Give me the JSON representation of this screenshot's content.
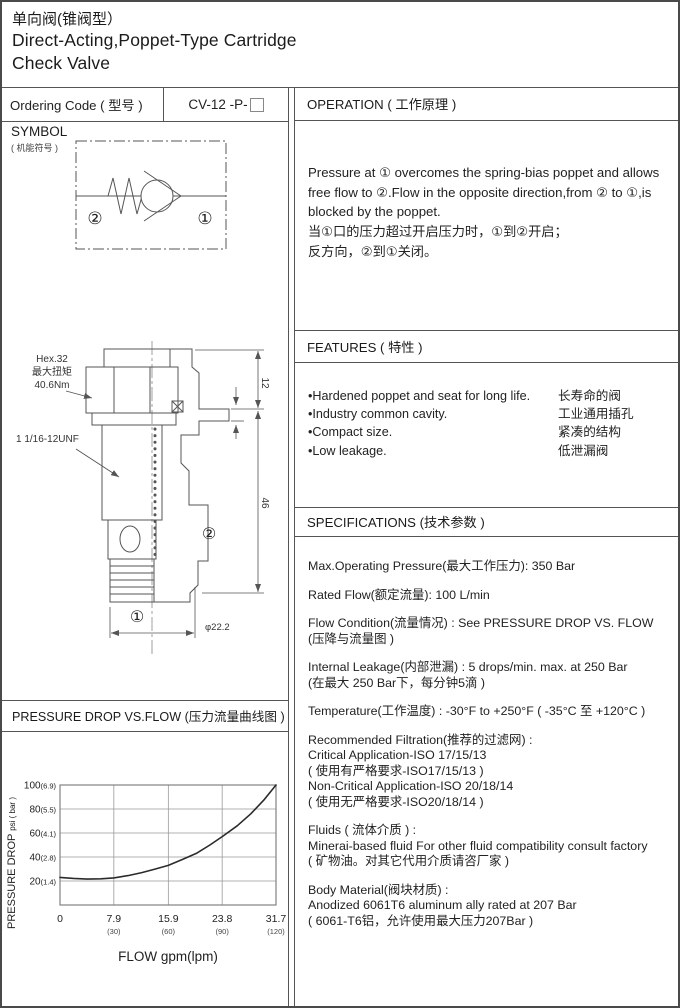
{
  "page": {
    "title_zh": "单向阀(锥阀型）",
    "title_en_line1": "Direct-Acting,Poppet-Type Cartridge",
    "title_en_line2": "Check Valve"
  },
  "ordering": {
    "label": "Ordering Code ( 型号 )",
    "code": "CV-12 -P-"
  },
  "symbol": {
    "heading": "SYMBOL",
    "heading_zh": "( 机能符号 )",
    "port1": "①",
    "port2": "②"
  },
  "drawing": {
    "hex_label_line1": "Hex.32",
    "hex_label_line2": "最大扭矩",
    "hex_label_line3": "40.6Nm",
    "thread_label": "1 1/16-12UNF",
    "dim_upper": "12",
    "dim_lower": "46",
    "dim_diameter": "φ22.2",
    "port1": "①",
    "port2": "②"
  },
  "operation": {
    "heading": "OPERATION ( 工作原理 )",
    "en": "Pressure at ① overcomes the spring-bias poppet and allows free flow to ②.Flow in the opposite direction,from ② to ①,is blocked by the poppet.",
    "zh1": "当①口的压力超过开启压力时，①到②开启；",
    "zh2": "反方向，②到①关闭。"
  },
  "features": {
    "heading": "FEATURES ( 特性 )",
    "items": [
      {
        "en": "•Hardened poppet and seat for long life.",
        "zh": "长寿命的阀"
      },
      {
        "en": "•Industry common cavity.",
        "zh": "工业通用插孔"
      },
      {
        "en": "•Compact size.",
        "zh": "紧凑的结构"
      },
      {
        "en": "•Low leakage.",
        "zh": "低泄漏阀"
      }
    ]
  },
  "specifications": {
    "heading": "SPECIFICATIONS (技术参数 )",
    "items": [
      [
        "Max.Operating Pressure(最大工作压力): 350 Bar"
      ],
      [
        "Rated Flow(额定流量): 100 L/min"
      ],
      [
        "Flow Condition(流量情况) : See PRESSURE DROP VS. FLOW",
        "(压降与流量图 )"
      ],
      [
        "Internal Leakage(内部泄漏) : 5 drops/min. max. at 250 Bar",
        "(在最大 250 Bar下，每分钟5滴 )"
      ],
      [
        "Temperature(工作温度) : -30°F to +250°F   ( -35°C 至 +120°C )"
      ],
      [
        "Recommended Filtration(推荐的过滤网) :",
        "Critical Application-ISO 17/15/13",
        "( 使用有严格要求-ISO17/15/13 )",
        "Non-Critical Application-ISO 20/18/14",
        "( 使用无严格要求-ISO20/18/14 )"
      ],
      [
        "Fluids ( 流体介质 ) :",
        "Minerai-based fluid For other  fluid compatibility consult  factory",
        "( 矿物油。对其它代用介质请咨厂家 )"
      ],
      [
        "Body Material(阀块材质) :",
        "Anodized 6061T6 aluminum ally rated at 207 Bar",
        "( 6061-T6铝，允许使用最大压力207Bar )"
      ]
    ]
  },
  "chart_section": {
    "heading": "PRESSURE DROP VS.FLOW  (压力流量曲线图 )"
  },
  "chart_data": {
    "type": "line",
    "title": "PRESSURE DROP VS.FLOW (压力流量曲线图)",
    "xlabel": "FLOW gpm(lpm)",
    "ylabel": "PRESSURE DROP psi ( bar )",
    "xlim": [
      0,
      31.7
    ],
    "ylim": [
      0,
      100
    ],
    "grid": true,
    "x_ticks": [
      {
        "value": 0,
        "label": "0",
        "label2": ""
      },
      {
        "value": 7.9,
        "label": "7.9",
        "label2": "(30)"
      },
      {
        "value": 15.9,
        "label": "15.9",
        "label2": "(60)"
      },
      {
        "value": 23.8,
        "label": "23.8",
        "label2": "(90)"
      },
      {
        "value": 31.7,
        "label": "31.7",
        "label2": "(120)"
      }
    ],
    "y_ticks": [
      {
        "value": 20,
        "label": "20",
        "label2": "(1.4)"
      },
      {
        "value": 40,
        "label": "40",
        "label2": "(2.8)"
      },
      {
        "value": 60,
        "label": "60",
        "label2": "(4.1)"
      },
      {
        "value": 80,
        "label": "80",
        "label2": "(5.5)"
      },
      {
        "value": 100,
        "label": "100",
        "label2": "(6.9)"
      }
    ],
    "series": [
      {
        "name": "pressure-drop-curve",
        "x": [
          0,
          2,
          4,
          6,
          7.9,
          10,
          12,
          14,
          15.9,
          18,
          20,
          22,
          23.8,
          26,
          28,
          30,
          31.7
        ],
        "y": [
          23,
          22.2,
          21.6,
          21.8,
          22.6,
          24.5,
          27,
          30,
          33,
          38,
          43,
          50,
          57,
          66,
          76,
          88,
          100
        ]
      }
    ],
    "line_color": "#2b2b2b",
    "grid_color": "#999999"
  }
}
